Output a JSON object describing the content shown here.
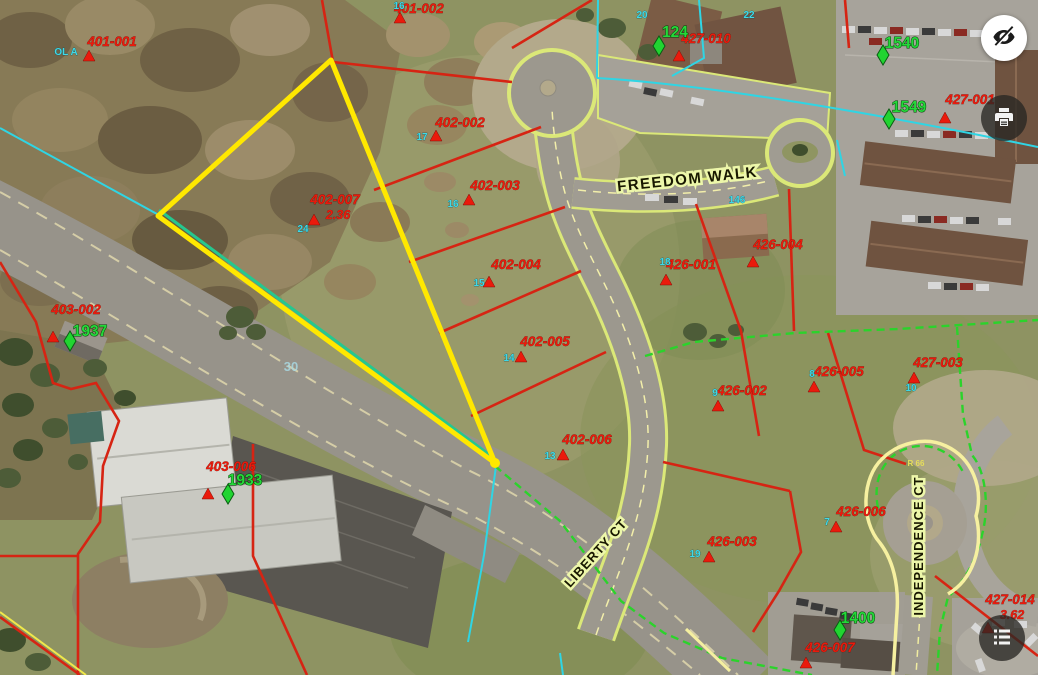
{
  "controls": {
    "visibility_button": {
      "icon": "eye-slash-icon"
    },
    "print_button": {
      "icon": "printer-icon"
    },
    "legend_button": {
      "icon": "legend-list-icon"
    }
  },
  "map": {
    "streets": [
      {
        "name": "FREEDOM WALK"
      },
      {
        "name": "LIBERTY CT"
      },
      {
        "name": "INDEPENDENCE CT"
      }
    ],
    "parcels": [
      {
        "id": "401-001"
      },
      {
        "id": "401-002"
      },
      {
        "id": "402-002"
      },
      {
        "id": "402-003"
      },
      {
        "id": "402-007",
        "area": "2.36"
      },
      {
        "id": "402-004"
      },
      {
        "id": "402-005"
      },
      {
        "id": "402-006"
      },
      {
        "id": "403-002"
      },
      {
        "id": "403-006"
      },
      {
        "id": "426-001"
      },
      {
        "id": "426-002"
      },
      {
        "id": "426-003"
      },
      {
        "id": "426-004"
      },
      {
        "id": "426-005"
      },
      {
        "id": "426-006"
      },
      {
        "id": "426-007"
      },
      {
        "id": "427-001"
      },
      {
        "id": "427-010"
      },
      {
        "id": "427-003"
      },
      {
        "id": "427-014",
        "area": "3.62"
      }
    ],
    "addresses": [
      {
        "number": "1937"
      },
      {
        "number": "1933"
      },
      {
        "number": "124"
      },
      {
        "number": "1540"
      },
      {
        "number": "1549"
      },
      {
        "number": "1400"
      }
    ],
    "lot_numbers": [
      {
        "text": "OL A"
      },
      {
        "text": "16"
      },
      {
        "text": "20"
      },
      {
        "text": "22"
      },
      {
        "text": "24"
      },
      {
        "text": "17"
      },
      {
        "text": "16"
      },
      {
        "text": "15"
      },
      {
        "text": "14"
      },
      {
        "text": "13"
      },
      {
        "text": "18"
      },
      {
        "text": "146"
      },
      {
        "text": "9"
      },
      {
        "text": "8"
      },
      {
        "text": "10"
      },
      {
        "text": "19"
      },
      {
        "text": "7"
      },
      {
        "text": "30"
      },
      {
        "text": "R 66"
      }
    ],
    "colors": {
      "parcel_line": "#d62413",
      "selected_parcel": "#ffe800",
      "adjacent_boundary": "#2bd32b",
      "utility_line": "#2fd5e4",
      "parcel_label": "#ea1a0c",
      "address_label": "#25d83a",
      "street_label_halo": "#edf7aa",
      "road_edge": "#dbe878"
    }
  }
}
